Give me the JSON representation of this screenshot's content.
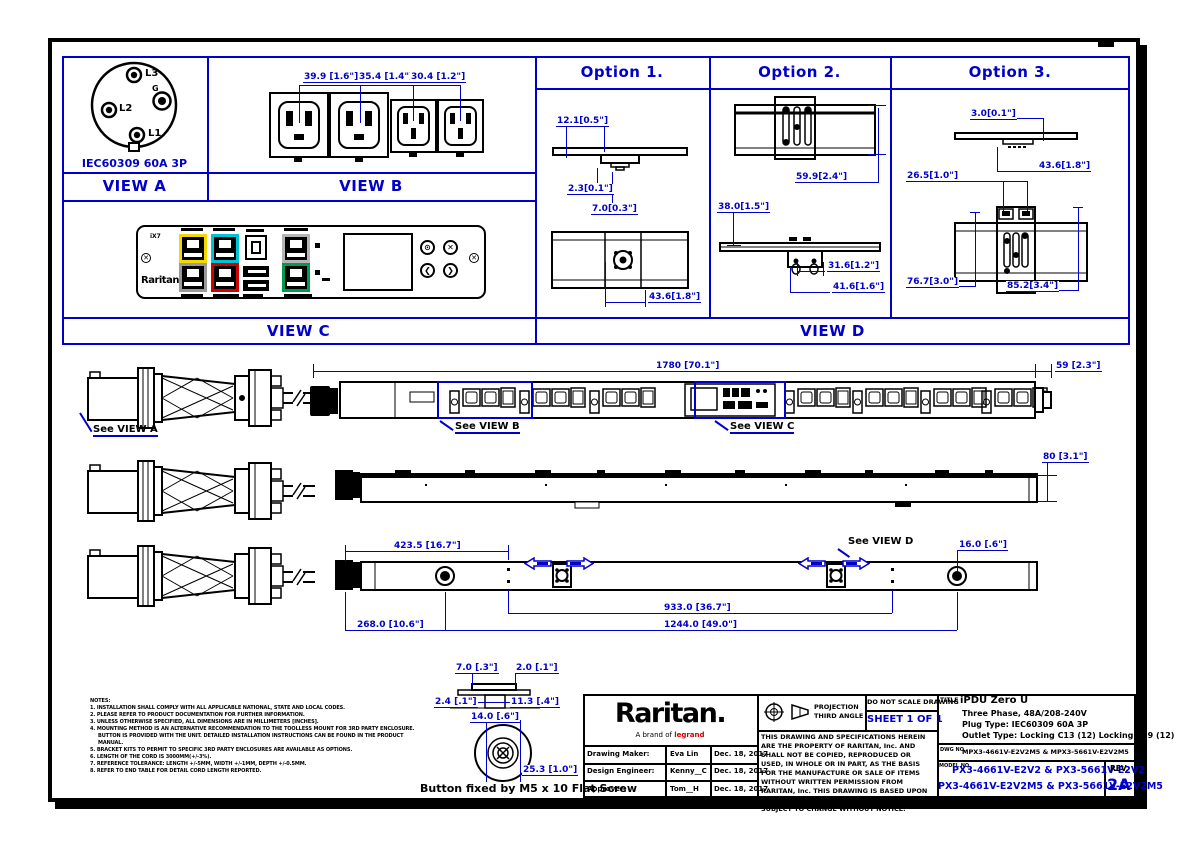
{
  "labels": {
    "view_a": "VIEW A",
    "view_b": "VIEW B",
    "view_c": "VIEW C",
    "view_d": "VIEW D",
    "option1": "Option 1.",
    "option2": "Option  2.",
    "option3": "Option 3.",
    "see_view_a": "See VIEW A",
    "see_view_b": "See VIEW B",
    "see_view_c": "See VIEW C",
    "see_view_d": "See VIEW D"
  },
  "view_a": {
    "caption": "IEC60309 60A 3P",
    "pin_l1": "L1",
    "pin_l2": "L2",
    "pin_l3": "L3",
    "pin_g": "G"
  },
  "view_b": {
    "dims": [
      "39.9 [1.6\"]",
      "35.4 [1.4\"]",
      "30.4 [1.2\"]"
    ]
  },
  "view_c": {
    "tag": "iX7",
    "brand": "Raritan"
  },
  "options": {
    "o1": {
      "dims": [
        "12.1[0.5\"]",
        "2.3[0.1\"]",
        "7.0[0.3\"]",
        "43.6[1.8\"]"
      ]
    },
    "o2": {
      "dims": [
        "59.9[2.4\"]",
        "38.0[1.5\"]",
        "31.6[1.2\"]",
        "41.6[1.6\"]"
      ]
    },
    "o3": {
      "dims": [
        "3.0[0.1\"]",
        "43.6[1.8\"]",
        "26.5[1.0\"]",
        "76.7[3.0\"]",
        "85.2[3.4\"]"
      ]
    }
  },
  "assembly": {
    "dim_total": "1780 [70.1\"]",
    "dim_end": "59 [2.3\"]",
    "dim_depth": "80 [3.1\"]",
    "dim_a": "423.5 [16.7\"]",
    "dim_b": "16.0 [.6\"]",
    "dim_c": "933.0 [36.7\"]",
    "dim_d": "268.0 [10.6\"]",
    "dim_e": "1244.0 [49.0\"]"
  },
  "button_detail": {
    "dims": [
      "7.0 [.3\"]",
      "2.0 [.1\"]",
      "2.4 [.1\"]",
      "11.3 [.4\"]",
      "14.0 [.6\"]",
      "25.3 [1.0\"]"
    ],
    "caption": "Button fixed by M5 x 10 Flat Screw"
  },
  "notes": {
    "title": "NOTES:",
    "lines": [
      "1. INSTALLATION SHALL COMPLY WITH ALL APPLICABLE NATIONAL, STATE AND LOCAL CODES.",
      "2. PLEASE REFER TO PRODUCT DOCUMENTATION FOR FURTHER INFORMATION.",
      "3. UNLESS OTHERWISE SPECIFIED, ALL DIMENSIONS ARE IN MILLIMETERS [INCHES].",
      "4. MOUNTING METHOD IS AN ALTERNATIVE RECOMMENDATION TO THE TOOLLESS MOUNT FOR 3RD PARTY ENCLOSURE.",
      "BUTTON IS PROVIDED WITH THE UNIT. DETAILED INSTALLATION INSTRUCTIONS CAN BE FOUND IN THE PRODUCT MANUAL.",
      "5. BRACKET KITS TO PERMIT TO SPECIFIC 3RD PARTY ENCLOSURES ARE AVAILABLE AS OPTIONS.",
      "6. LENGTH OF THE CORD IS 3000MM(+/-3%).",
      "7. REFERENCE TOLERANCE: LENGTH +/-5MM, WIDTH +/-1MM, DEPTH +/-0.5MM.",
      "8. REFER TO END TABLE FOR DETAIL CORD LENGTH REPORTED."
    ]
  },
  "title_block": {
    "brand": "Raritan.",
    "brand_sub_prefix": "A brand of",
    "brand_sub_red": "legrand",
    "rows": [
      {
        "label": "Drawing Maker:",
        "value": "Eva Lin",
        "date": "Dec. 18, 2017"
      },
      {
        "label": "Design Engineer:",
        "value": "Kenny__C",
        "date": "Dec. 18, 2017"
      },
      {
        "label": "Approver:",
        "value": "Tom__H",
        "date": "Dec. 18, 2017"
      }
    ],
    "projection_line1": "PROJECTION",
    "projection_line2": "THIRD ANGLE",
    "no_scale": "DO NOT SCALE DRAWING",
    "sheet": "SHEET 1 OF 1",
    "disclaimer": "THIS DRAWING AND SPECIFICATIONS HEREIN ARE THE PROPERTY OF RARITAN, Inc. AND SHALL NOT BE COPIED, REPRODUCED OR USED, IN WHOLE OR IN PART, AS THE BASIS FOR THE MANUFACTURE OR SALE OF ITEMS WITHOUT WRITTEN PERMISSION FROM RARITAN, Inc. THIS DRAWING IS BASED UPON LATEST AVAILABLE INFORMATION AND IS SUBJECT TO CHANGE WITHOUT NOTICE.",
    "title_label": "TITLE",
    "title_line1": "iPDU Zero U",
    "title_line2": "Three Phase, 48A/208-240V",
    "title_line3": "Plug Type: IEC60309 60A 3P",
    "title_line4": "Outlet Type: Locking C13 (12) Locking C19 (12)",
    "dwg_label": "DWG NO.",
    "dwg_value": "MPX3-4661V-E2V2M5 & MPX3-5661V-E2V2M5",
    "model_label": "MODEL NO.",
    "model_line1": "PX3-4661V-E2V2 & PX3-5661V-E2V2",
    "model_line2": "PX3-4661V-E2V2M5 & PX3-5661V-E2V2M5",
    "rev_label": "REV.",
    "rev_value": "2A"
  }
}
